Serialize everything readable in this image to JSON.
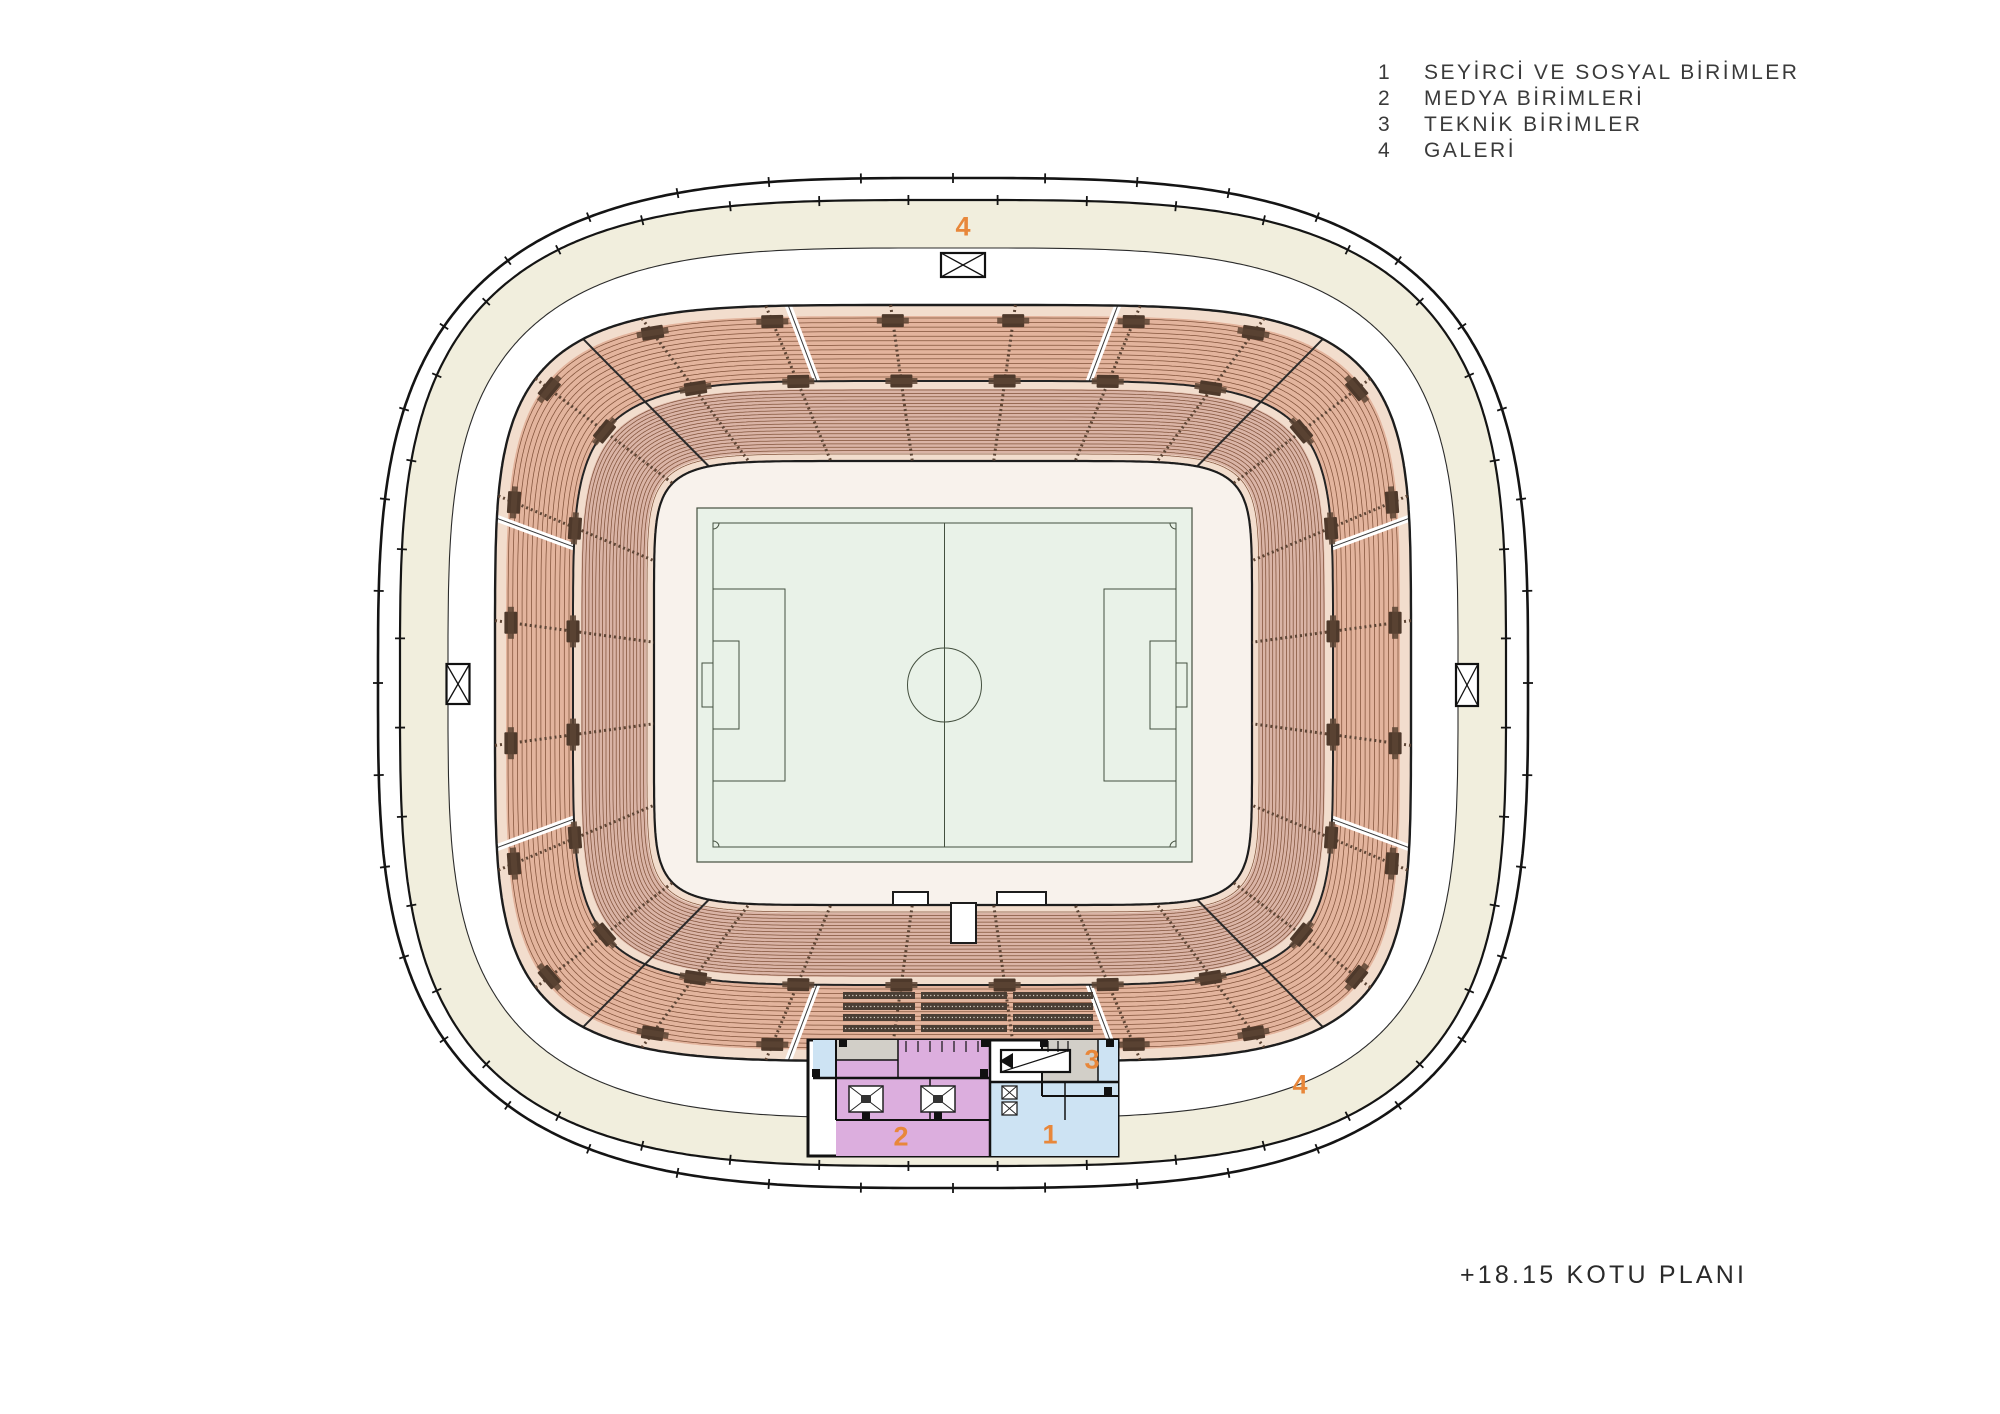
{
  "legend": {
    "items": [
      {
        "num": "1",
        "label": "SEYİRCİ VE SOSYAL BİRİMLER"
      },
      {
        "num": "2",
        "label": "MEDYA BİRİMLERİ"
      },
      {
        "num": "3",
        "label": "TEKNİK BİRİMLER"
      },
      {
        "num": "4",
        "label": "GALERİ"
      }
    ]
  },
  "title": {
    "text": "+18.15 KOTU PLANI"
  },
  "zones": {
    "gallery_top": "4",
    "gallery_bottom_right": "4",
    "media": "2",
    "spectator": "1",
    "technical": "3"
  },
  "icons": {
    "gate_marker": "crossed-box"
  },
  "colors": {
    "background": "#ffffff",
    "line": "#1a1a1a",
    "cream_ring": "#f1eedd",
    "bowl_walkway": "#f2ddcd",
    "tier_upper": "#e3b49d",
    "tier_lower": "#dab4a6",
    "seat_row_line": "#82533b",
    "stair_block": "#4e392b",
    "aisle_line": "#5c4434",
    "concourse": "#f8f2ec",
    "pitch_green": "#e9f2e8",
    "pitch_line": "#44503f",
    "press_dark": "#4a3e34",
    "building_pink": "#dcaede",
    "building_blue": "#cde3f3",
    "building_gray": "#d2cfc8",
    "building_wall": "#111111",
    "orange_label": "#e8873a"
  }
}
